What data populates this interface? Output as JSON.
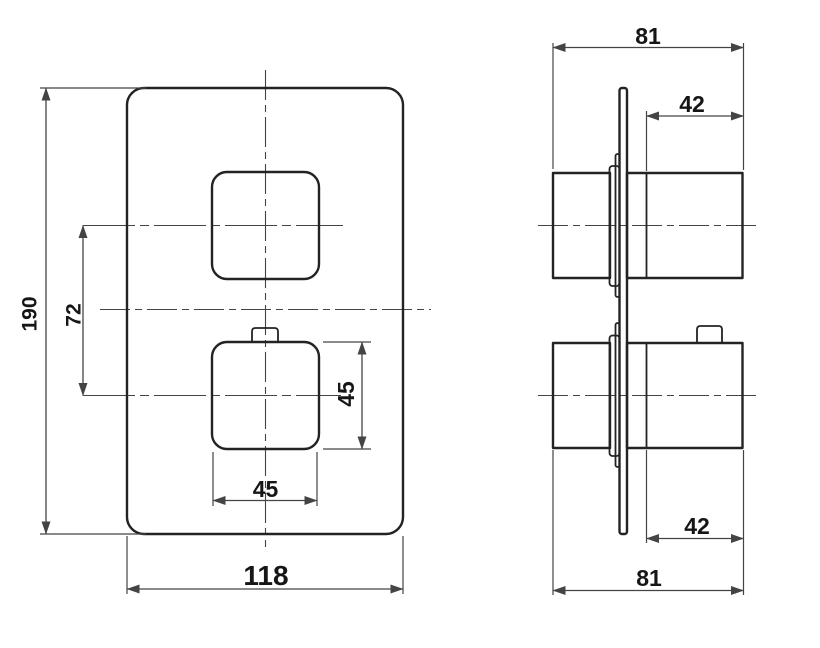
{
  "drawing": {
    "type": "technical-dimension-drawing",
    "subject": "concealed thermostatic shower mixer valve, front and side view"
  },
  "front_view": {
    "dims": {
      "plate_height": "190",
      "knob_spacing": "72",
      "knob_height": "45",
      "knob_width": "45",
      "plate_width": "118"
    }
  },
  "side_view": {
    "dims": {
      "total_depth_top": "81",
      "knob_depth_top": "42",
      "knob_depth_bottom": "42",
      "total_depth_bottom": "81"
    }
  },
  "colors": {
    "background": "#ffffff",
    "object_line": "#232323",
    "dimension_line": "#444444",
    "label_text": "#161616"
  }
}
